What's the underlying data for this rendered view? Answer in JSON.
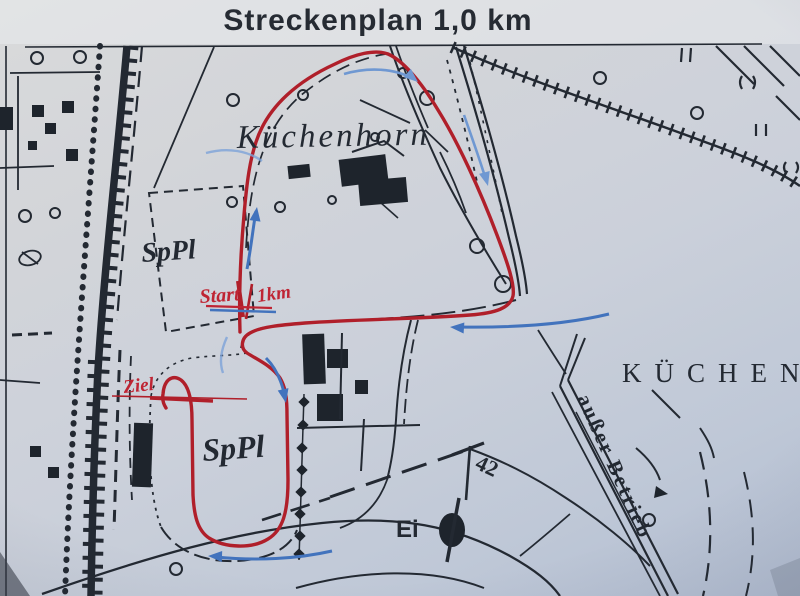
{
  "title": "Streckenplan 1,0 km",
  "labels": {
    "forest_area": "Küchenhorn",
    "district": "KÜCHEN",
    "sports_field_upper": "SpPl",
    "sports_field_lower": "SpPl",
    "start": "Start",
    "start_distance": "1km",
    "finish": "Ziel",
    "railway_status": "außer Betrieb",
    "pond": "Ei",
    "elevation_point": "42"
  },
  "colors": {
    "paper": "#ccd1db",
    "map_ink": "#232932",
    "course_red": "#b01f2a",
    "arrow_blue": "#4273bd",
    "annotation_red": "#bf2433"
  }
}
